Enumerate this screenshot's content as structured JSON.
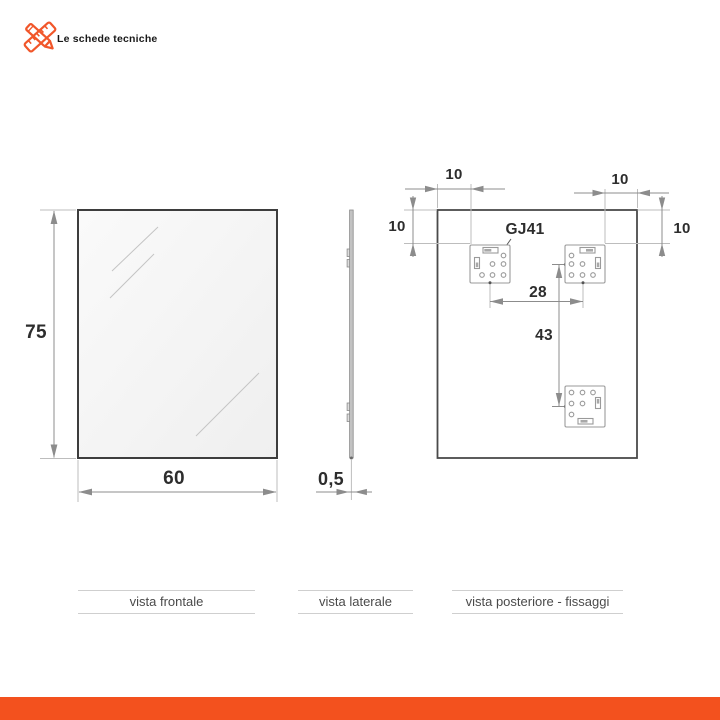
{
  "header": {
    "brand": "Le schede tecniche"
  },
  "accent_color": "#F3511E",
  "drawing_line_color": "#8c8c8c",
  "views": {
    "front": {
      "label": "vista frontale",
      "height_dim": "75",
      "width_dim": "60"
    },
    "side": {
      "label": "vista laterale",
      "thickness_dim": "0,5"
    },
    "rear": {
      "label": "vista posteriore - fissaggi",
      "bracket_model": "GJ41",
      "offset_top_left": "10",
      "offset_top_right": "10",
      "offset_side_left": "10",
      "offset_side_right": "10",
      "bracket_spacing": "28",
      "vertical_spacing": "43"
    }
  }
}
